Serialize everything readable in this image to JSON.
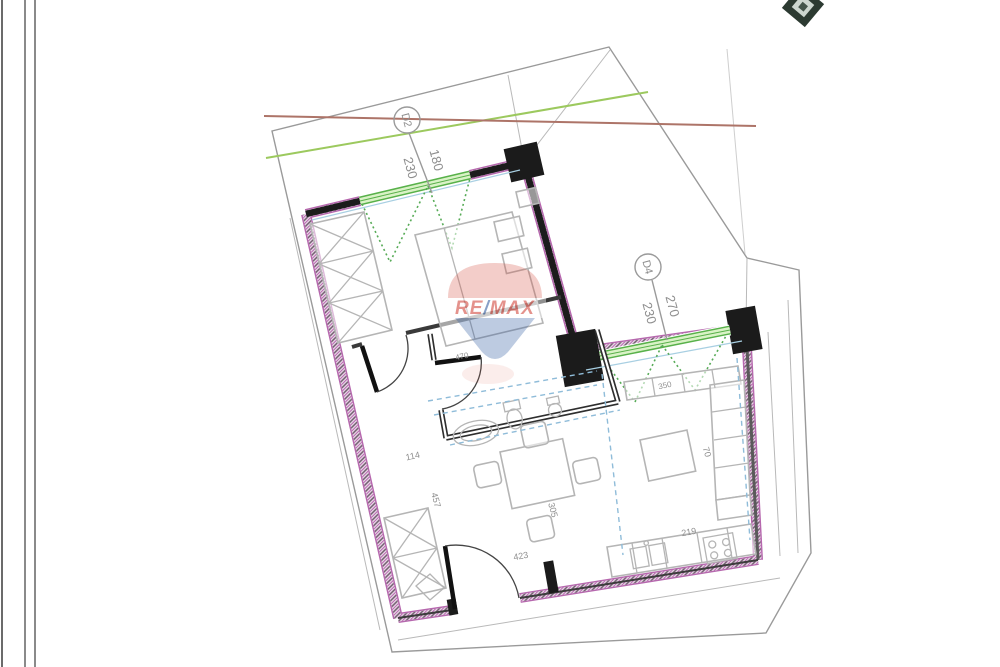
{
  "watermark": {
    "re": "RE",
    "slash": "/",
    "max": "MAX"
  },
  "plan": {
    "openings": {
      "d2": {
        "tag": "D2",
        "width": "180",
        "height": "230"
      },
      "d4": {
        "tag": "D4",
        "width": "270",
        "height": "230"
      }
    },
    "dims": {
      "hall": "114",
      "left_run": "457",
      "dining_bottom": "423",
      "dining_side": "305",
      "bath_top": "470",
      "kitchen": "219",
      "sofa": "70",
      "living_top": "350"
    },
    "colors": {
      "wall_magenta": "#b668ae",
      "wall_core": "#4a4350",
      "window_green": "#58b14a",
      "window_fill": "#d9f2c6",
      "swing_green": "#57ab57",
      "guide_blue": "#8fbcd9",
      "outline_gray": "#9a9a9a",
      "roof_green": "#9cc95e",
      "roof_brown": "#ad7468",
      "furniture_gray": "#b5b5b5",
      "dim_text_gray": "#8f8f8f",
      "remax_red": "#cf3a2f",
      "remax_blue": "#27549b"
    }
  }
}
